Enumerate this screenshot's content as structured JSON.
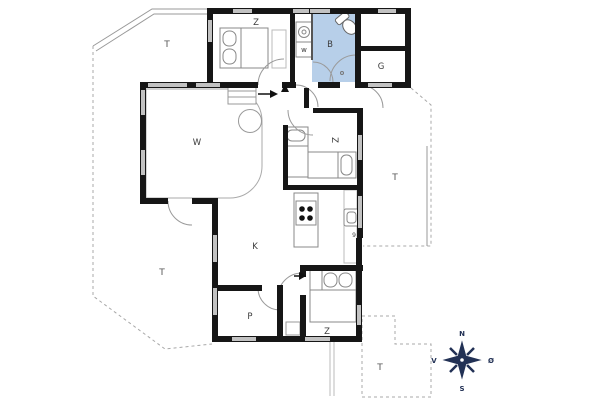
{
  "floorplan": {
    "rooms": {
      "bedroom_top": "Z",
      "utility": "w",
      "bathroom": "B",
      "guest_room": "G",
      "living_room": "W",
      "bedroom_middle": "Z",
      "kitchen": "K",
      "appliance_mark": "9",
      "pantry": "P",
      "bedroom_bottom": "Z"
    },
    "terraces": {
      "top_left": "T",
      "bottom_left": "T",
      "right": "T",
      "bottom_right": "T"
    },
    "compass": {
      "north": "N",
      "east": "Ø",
      "south": "S",
      "west": "V"
    },
    "colors": {
      "wall": "#161616",
      "window": "#c2c2c2",
      "bathroom_fill": "#b7cfe9",
      "thin_line": "#999999",
      "compass": "#223155"
    }
  }
}
